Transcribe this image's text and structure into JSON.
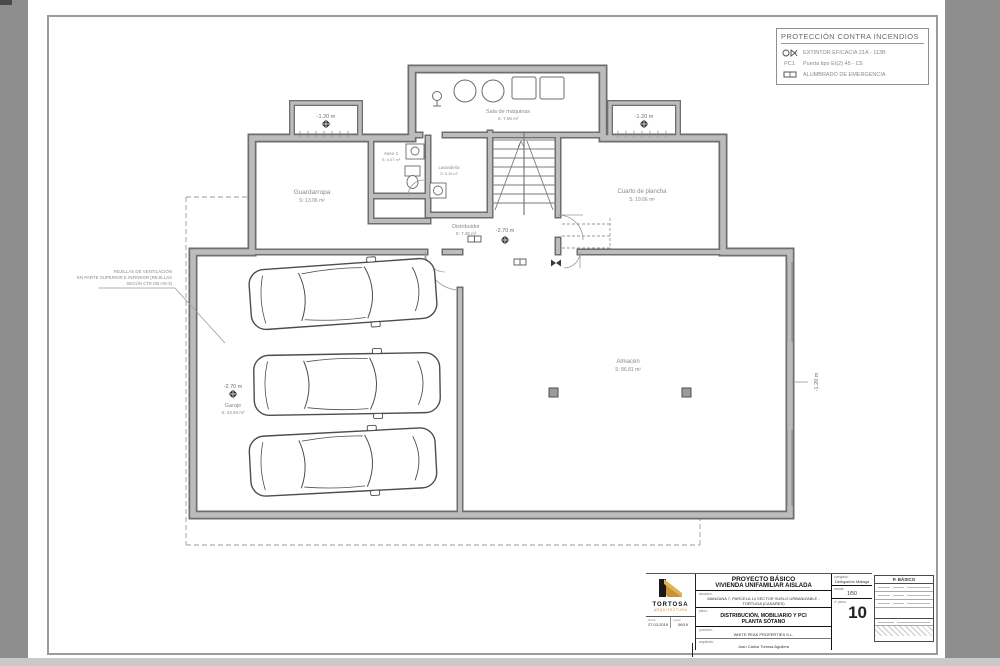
{
  "legend": {
    "title": "PROTECCIÓN CONTRA INCENDIOS",
    "extinguisher_label": "EXTINTOR EFICACIA 21A - 113B",
    "door_code": "PC1",
    "door_label": "Puerta tipo EI(2) 45 - C5",
    "light_label": "ALUMBRADO DE EMERGENCIA"
  },
  "plan": {
    "rooms": {
      "guardarropa": {
        "name": "Guardarropa",
        "area": "S: 13.06 m²"
      },
      "aseo": {
        "name": "Aseo 1",
        "area": "S: 4.07 m²"
      },
      "lavanderia": {
        "name": "Lavandería",
        "area": "S: 5.16 m²"
      },
      "maquinas": {
        "name": "Sala de máquinas",
        "area": "S: 7.06 m²"
      },
      "plancha": {
        "name": "Cuarto de plancha",
        "area": "S: 19.66 m²"
      },
      "distribuidor": {
        "name": "Distribuidor",
        "area": "S: 7.36 m²"
      },
      "garaje": {
        "name": "Garaje",
        "area": "S: 44.94 m²"
      },
      "almacen": {
        "name": "Almacén",
        "area": "S: 86.81 m²"
      }
    },
    "levels": {
      "vent_left": "-1.20 m",
      "vent_right": "-1.20 m",
      "distribuidor": "-2.70 m",
      "garaje": "-2.70 m",
      "right_wall": "-1.20 m"
    },
    "vent_note": {
      "line1": "REJILLAS DE VENTILACIÓN",
      "line2": "EN PARTE SUPERIOR E INFERIOR (REJILLAS",
      "line3": "SEGÚN CTE DB HS-3)"
    }
  },
  "titleblock": {
    "project_type": "PROYECTO BÁSICO",
    "project_name": "VIVIENDA UNIFAMILIAR AISLADA",
    "situacion_label": "situación:",
    "situacion_value": "MANZANA 7, PARCELA 14 SECTOR SUELO URBANIZABLE - TORTUGA (CASARES)",
    "plano_label": "plano:",
    "plano_line1": "DISTRIBUCIÓN, MOBILIARIO Y PCI",
    "plano_line2": "PLANTA SÓTANO",
    "promotor_label": "promotor:",
    "promotor_value": "WHITE PEAK PROPERTIES S.L.",
    "arquitecto_label": "arquitecto:",
    "arquitecto_value": "Juan Carlos Tortosa Aguilera",
    "colegiado_label": "colegiado:",
    "colegiado_value": "Delegación Málaga",
    "escala_label": "escala:",
    "escala_value": "1/50",
    "num_label": "nº plano:",
    "sheet_number": "10",
    "fecha_label": "fecha:",
    "fecha_value": "27.03.2019",
    "expediente_label": "expte:",
    "expediente_value": "06/19",
    "logo_name": "TORTOSA",
    "logo_sub": "ARQUITECTURA",
    "stamp_title": "P. BÁSICO"
  }
}
